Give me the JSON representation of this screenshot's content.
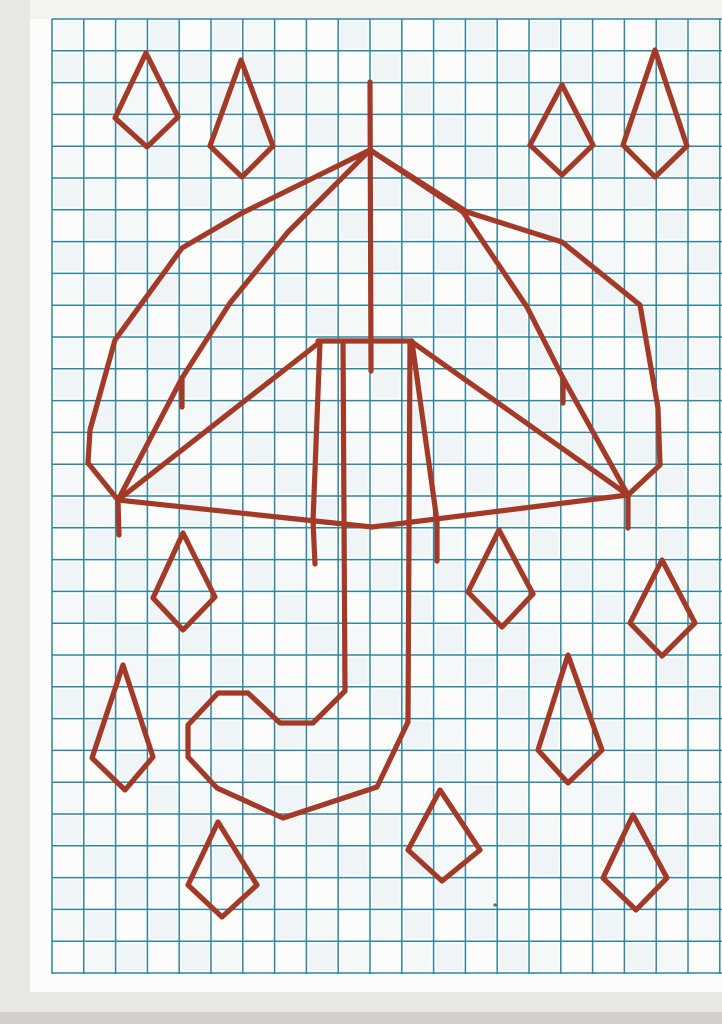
{
  "page": {
    "description": "Scanned squared-paper worksheet: red umbrella with curled handle and kite-shaped raindrops drawn over a teal grid",
    "canvas": {
      "width": 722,
      "height": 1024
    },
    "colors": {
      "scan_bg": "#e9e7e3",
      "paper": "#fcfcfa",
      "paper_margin": "#f4f3f0",
      "grid_line": "#2d87a2",
      "cell_tint_a": "#e4edf2",
      "cell_tint_b": "#eff4f6",
      "ink": "#a33a28",
      "bottom_band": "#d2cfcb",
      "speck": "#6b6a60"
    },
    "regions": [
      {
        "name": "paper-sheet",
        "x": 0,
        "y": 0,
        "w": 722,
        "h": 1024,
        "color": "paper"
      },
      {
        "name": "top-margin",
        "x": 0,
        "y": 0,
        "w": 722,
        "h": 19,
        "color": "paper_margin"
      },
      {
        "name": "left-scan-edge",
        "x": 0,
        "y": 0,
        "w": 30,
        "h": 1024,
        "color": "scan_bg"
      },
      {
        "name": "bottom-shadow",
        "x": 0,
        "y": 992,
        "w": 722,
        "h": 20,
        "color": "scan_bg"
      },
      {
        "name": "bottom-edge-band",
        "x": 0,
        "y": 1012,
        "w": 722,
        "h": 12,
        "color": "bottom_band"
      }
    ],
    "grid": {
      "x0": 52,
      "y0": 19,
      "x1": 722,
      "y1": 974,
      "cell": 31.8,
      "line_width": 1.5
    },
    "drawing": {
      "line_width": 5.2,
      "polylines": [
        {
          "name": "umbrella-pole",
          "points": [
            [
              370,
              82
            ],
            [
              371,
              371
            ]
          ]
        },
        {
          "name": "hub-bar",
          "points": [
            [
              318,
              341
            ],
            [
              412,
              341
            ]
          ]
        },
        {
          "name": "canopy-outer-left",
          "points": [
            [
              370,
              150
            ],
            [
              242,
              213
            ],
            [
              182,
              248
            ],
            [
              115,
              340
            ],
            [
              90,
              430
            ],
            [
              88,
              463
            ],
            [
              118,
              500
            ]
          ]
        },
        {
          "name": "canopy-outer-right",
          "points": [
            [
              370,
              150
            ],
            [
              467,
              212
            ],
            [
              562,
              242
            ],
            [
              640,
              305
            ],
            [
              658,
              408
            ],
            [
              660,
              465
            ],
            [
              628,
              495
            ]
          ]
        },
        {
          "name": "canopy-bottom-edge",
          "points": [
            [
              118,
              500
            ],
            [
              372,
              527
            ],
            [
              628,
              495
            ]
          ]
        },
        {
          "name": "canopy-rib-left",
          "points": [
            [
              370,
              150
            ],
            [
              288,
              232
            ],
            [
              230,
              303
            ],
            [
              182,
              378
            ],
            [
              118,
              500
            ]
          ]
        },
        {
          "name": "canopy-rib-right",
          "points": [
            [
              370,
              150
            ],
            [
              463,
              212
            ],
            [
              527,
              307
            ],
            [
              563,
              378
            ],
            [
              628,
              495
            ]
          ]
        },
        {
          "name": "rib-fringe-left",
          "points": [
            [
              182,
              378
            ],
            [
              182,
              407
            ]
          ]
        },
        {
          "name": "rib-fringe-right",
          "points": [
            [
              563,
              378
            ],
            [
              563,
              403
            ]
          ]
        },
        {
          "name": "edge-fringe-left",
          "points": [
            [
              118,
              500
            ],
            [
              119,
              535
            ]
          ]
        },
        {
          "name": "edge-fringe-right",
          "points": [
            [
              628,
              495
            ],
            [
              628,
              528
            ]
          ]
        },
        {
          "name": "spoke-left-outer",
          "points": [
            [
              320,
              342
            ],
            [
              118,
              500
            ]
          ]
        },
        {
          "name": "spoke-left-inner",
          "points": [
            [
              320,
              342
            ],
            [
              313,
              521
            ]
          ]
        },
        {
          "name": "spoke-fringe-left",
          "points": [
            [
              313,
              521
            ],
            [
              315,
              564
            ]
          ]
        },
        {
          "name": "spoke-right-outer",
          "points": [
            [
              412,
              342
            ],
            [
              628,
              495
            ]
          ]
        },
        {
          "name": "spoke-right-inner",
          "points": [
            [
              412,
              342
            ],
            [
              437,
              521
            ]
          ]
        },
        {
          "name": "spoke-fringe-right",
          "points": [
            [
              437,
              521
            ],
            [
              437,
              561
            ]
          ]
        },
        {
          "name": "handle-shaft-left",
          "points": [
            [
              343,
              341
            ],
            [
              345,
              691
            ]
          ]
        },
        {
          "name": "handle-shaft-right",
          "points": [
            [
              410,
              341
            ],
            [
              408,
              722
            ]
          ]
        },
        {
          "name": "handle-hook",
          "points": [
            [
              345,
              691
            ],
            [
              313,
              723
            ],
            [
              280,
              723
            ],
            [
              248,
              693
            ],
            [
              218,
              693
            ],
            [
              188,
              725
            ],
            [
              188,
              757
            ],
            [
              217,
              788
            ],
            [
              283,
              818
            ],
            [
              377,
              787
            ],
            [
              408,
              722
            ]
          ]
        }
      ],
      "raindrops": [
        {
          "name": "raindrop-top-left-1",
          "size": "small",
          "points": [
            [
              146,
              53
            ],
            [
              178,
              117
            ],
            [
              147,
              147
            ],
            [
              115,
              118
            ]
          ]
        },
        {
          "name": "raindrop-top-left-2",
          "size": "large",
          "points": [
            [
              241,
              60
            ],
            [
              273,
              146
            ],
            [
              242,
              177
            ],
            [
              210,
              146
            ]
          ]
        },
        {
          "name": "raindrop-top-right-1",
          "size": "small",
          "points": [
            [
              562,
              85
            ],
            [
              593,
              145
            ],
            [
              562,
              175
            ],
            [
              530,
              145
            ]
          ]
        },
        {
          "name": "raindrop-top-right-2",
          "size": "large",
          "points": [
            [
              655,
              50
            ],
            [
              687,
              146
            ],
            [
              655,
              177
            ],
            [
              623,
              145
            ]
          ]
        },
        {
          "name": "raindrop-mid-left",
          "size": "small",
          "points": [
            [
              183,
              533
            ],
            [
              215,
              597
            ],
            [
              183,
              630
            ],
            [
              153,
              598
            ]
          ]
        },
        {
          "name": "raindrop-mid-right",
          "size": "small",
          "points": [
            [
              499,
              530
            ],
            [
              533,
              594
            ],
            [
              502,
              627
            ],
            [
              468,
              592
            ]
          ]
        },
        {
          "name": "raindrop-mid-far-right",
          "size": "small",
          "points": [
            [
              662,
              560
            ],
            [
              695,
              623
            ],
            [
              662,
              656
            ],
            [
              630,
              623
            ]
          ]
        },
        {
          "name": "raindrop-low-left",
          "size": "large",
          "points": [
            [
              123,
              665
            ],
            [
              153,
              757
            ],
            [
              125,
              790
            ],
            [
              92,
              758
            ]
          ]
        },
        {
          "name": "raindrop-low-right",
          "size": "large",
          "points": [
            [
              568,
              655
            ],
            [
              602,
              750
            ],
            [
              568,
              783
            ],
            [
              538,
              750
            ]
          ]
        },
        {
          "name": "raindrop-bottom-left",
          "size": "small",
          "points": [
            [
              218,
              822
            ],
            [
              257,
              885
            ],
            [
              222,
              917
            ],
            [
              188,
              885
            ]
          ]
        },
        {
          "name": "raindrop-bottom-center",
          "size": "small",
          "points": [
            [
              440,
              790
            ],
            [
              480,
              850
            ],
            [
              442,
              881
            ],
            [
              408,
              850
            ]
          ]
        },
        {
          "name": "raindrop-bottom-right",
          "size": "small",
          "points": [
            [
              633,
              815
            ],
            [
              667,
              878
            ],
            [
              636,
              910
            ],
            [
              603,
              878
            ]
          ]
        }
      ]
    },
    "specks": [
      {
        "x": 495,
        "y": 905
      }
    ]
  }
}
